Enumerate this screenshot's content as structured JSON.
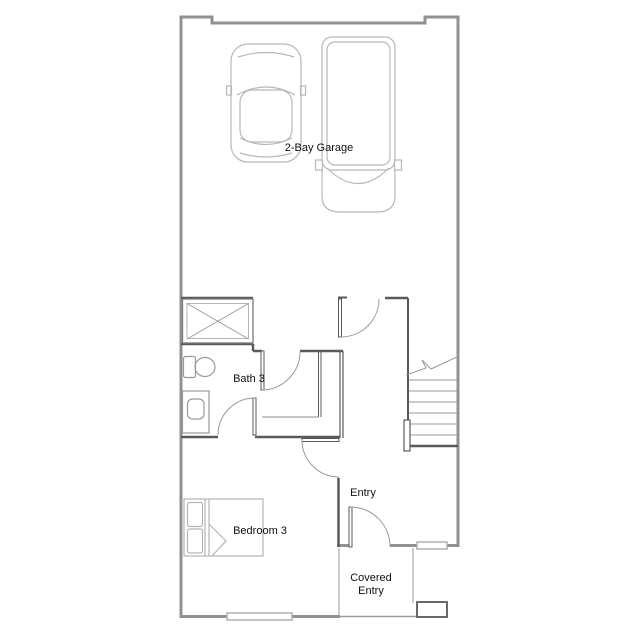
{
  "rooms": {
    "garage": {
      "label": "2-Bay Garage"
    },
    "bath": {
      "label": "Bath 3"
    },
    "entry": {
      "label": "Entry"
    },
    "bedroom": {
      "label": "Bedroom 3"
    },
    "covered_entry": {
      "line1": "Covered",
      "line2": "Entry"
    }
  },
  "elements": {
    "vehicles": [
      "car",
      "truck"
    ],
    "bath_fixtures": [
      "shower",
      "toilet",
      "vanity-sink"
    ],
    "bedroom_furniture": [
      "bed"
    ],
    "stairs": "staircase-with-break-line",
    "doors": [
      "garage-door",
      "bath-door",
      "bath-bedroom-door",
      "bedroom-door",
      "front-door"
    ],
    "windows": [
      "bedroom-window",
      "entry-window"
    ],
    "porch": [
      "porch-column"
    ]
  },
  "colors": {
    "background": "#ffffff",
    "exterior_wall": "#919191",
    "interior_wall": "#5a5a5a",
    "fixture_line": "#9a9a9a",
    "vehicle_line": "#b8b8b8",
    "furniture_line": "#b5b5b5",
    "label_text": "#111111"
  }
}
